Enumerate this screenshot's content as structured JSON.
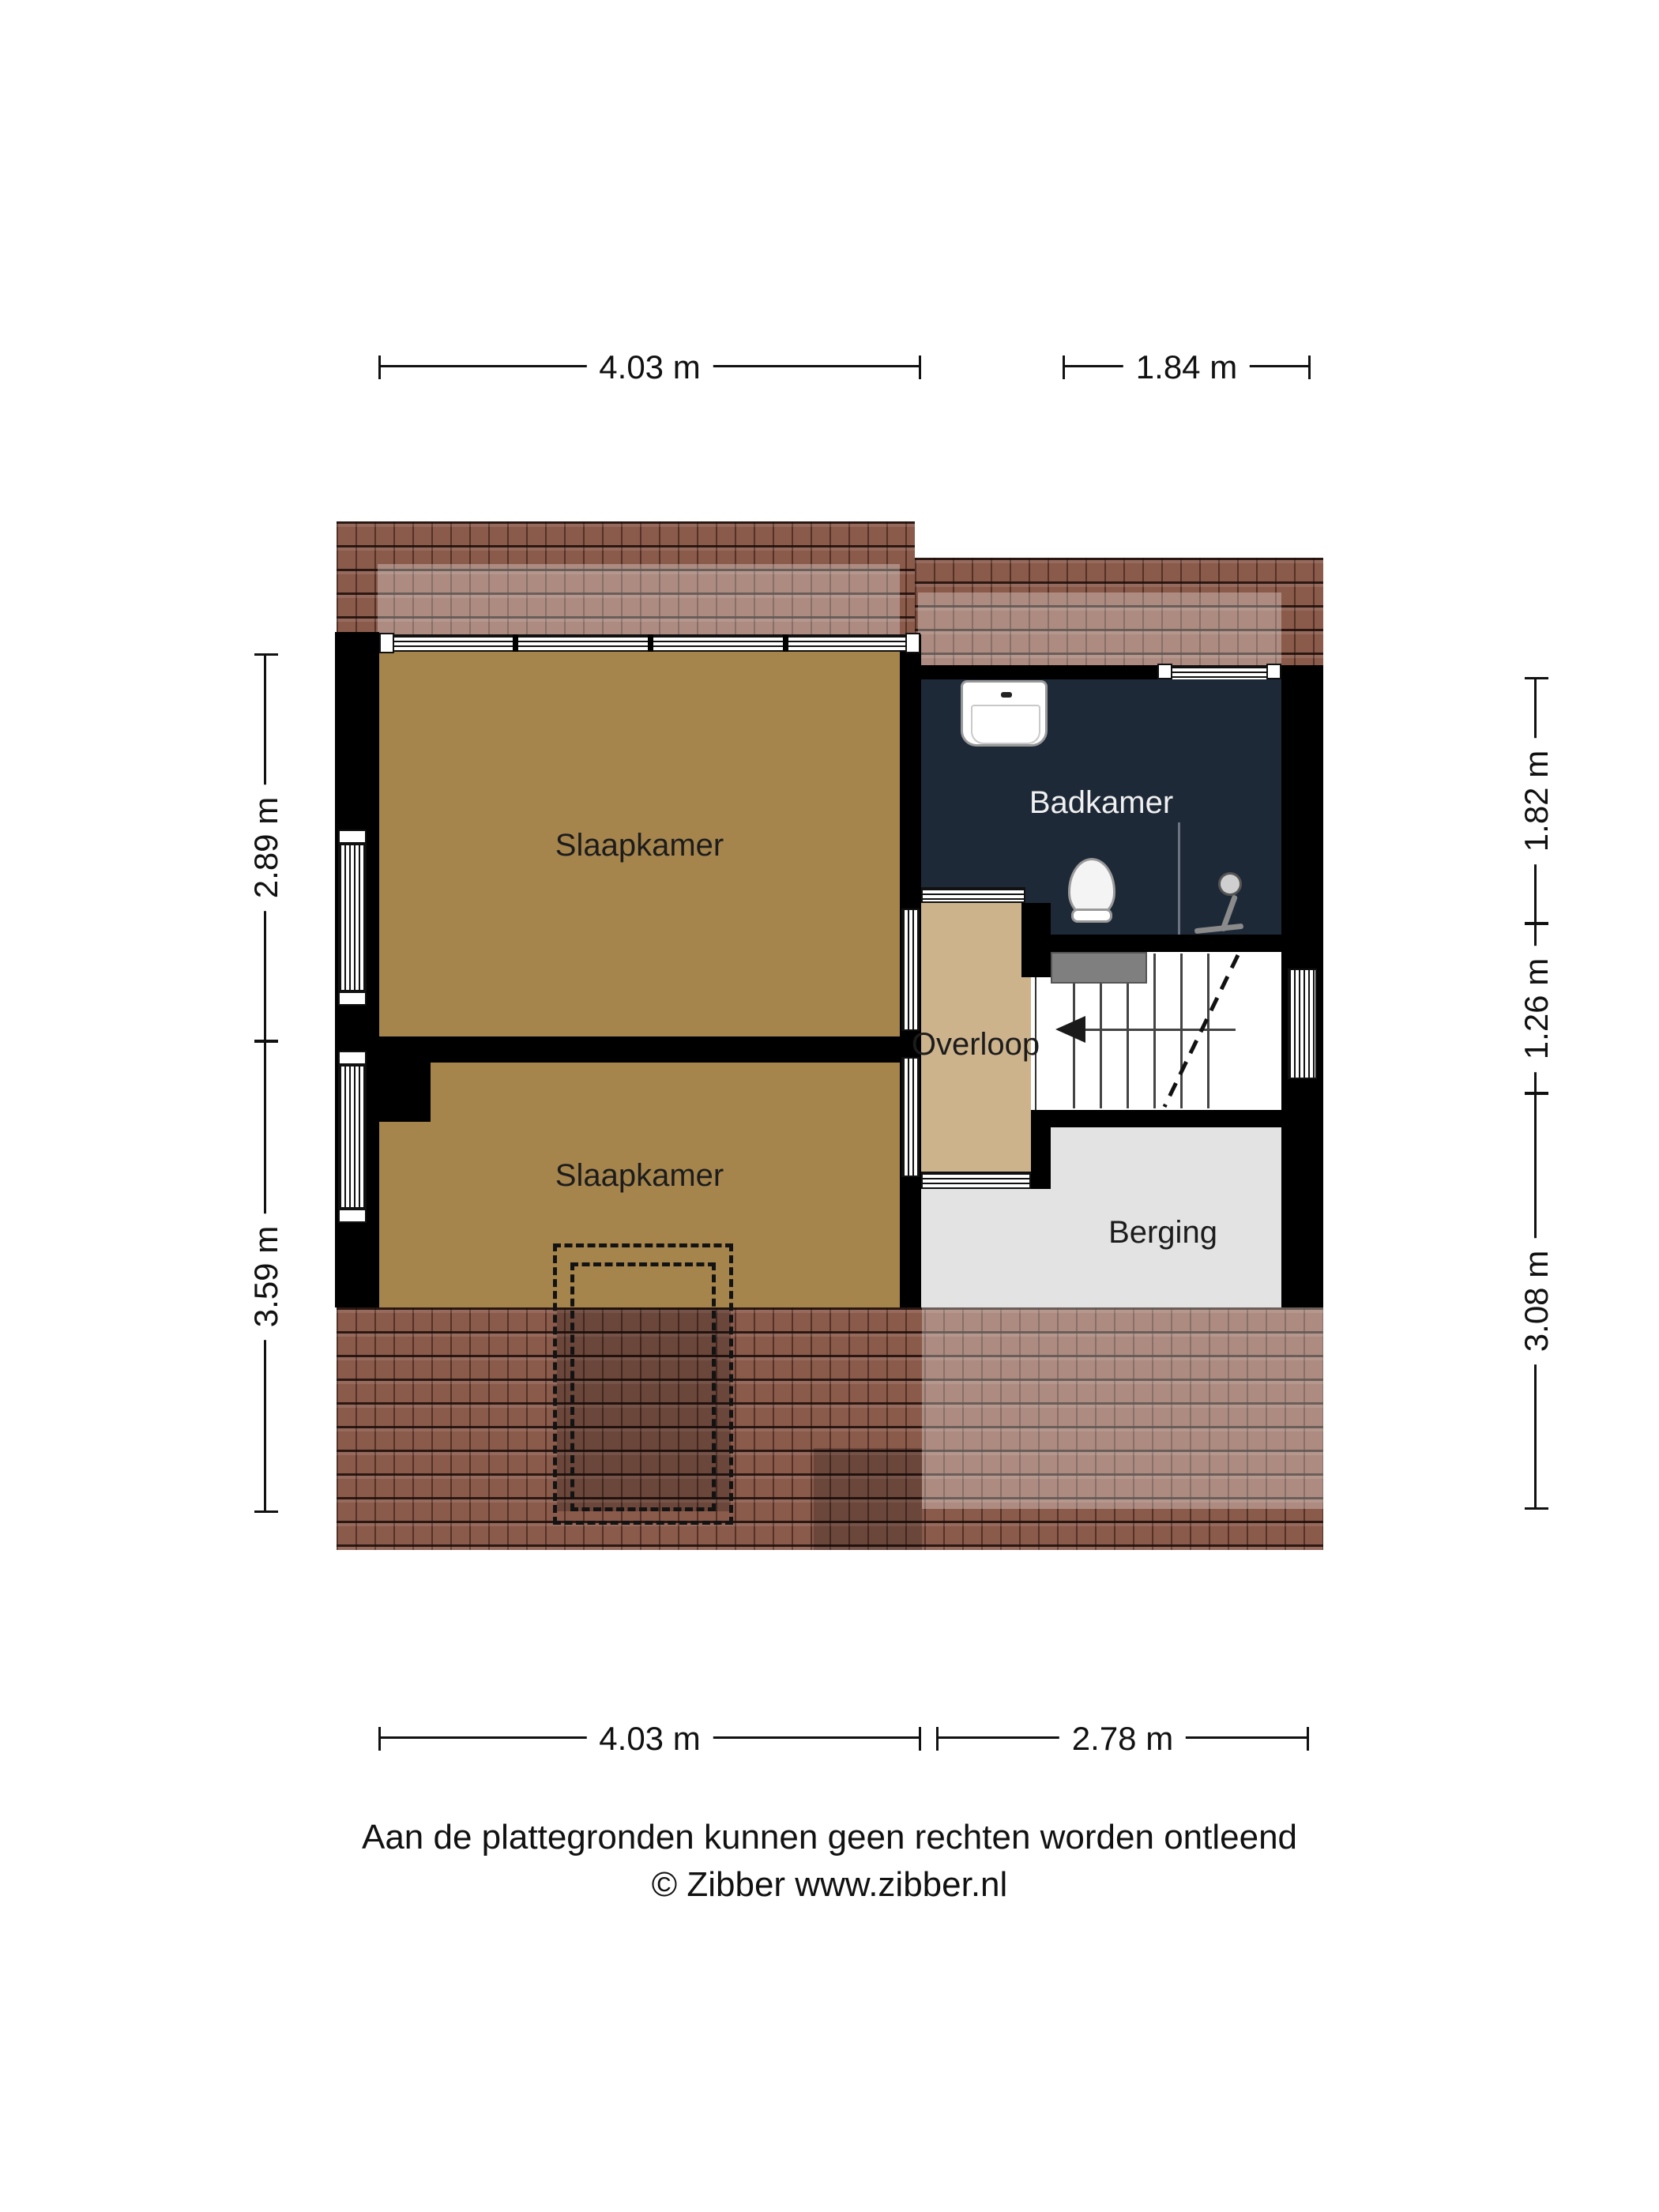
{
  "rooms": {
    "slaapkamer1": {
      "label": "Slaapkamer"
    },
    "badkamer": {
      "label": "Badkamer"
    },
    "overloop": {
      "label": "Overloop"
    },
    "slaapkamer2": {
      "label": "Slaapkamer"
    },
    "berging": {
      "label": "Berging"
    }
  },
  "dims": {
    "top_left": "4.03 m",
    "top_right": "1.84 m",
    "left_top": "2.89 m",
    "left_bottom": "3.59 m",
    "right_top": "1.82 m",
    "right_middle": "1.26 m",
    "right_bottom": "3.08 m",
    "bottom_left": "4.03 m",
    "bottom_right": "2.78 m"
  },
  "footer": {
    "line1": "Aan de plattegronden kunnen geen rechten worden ontleend",
    "line2": "© Zibber www.zibber.nl"
  },
  "fixtures": [
    "sink-icon",
    "toilet-icon",
    "shower-icon",
    "radiator",
    "stairs-up-arrow",
    "dormer-dashed-outline"
  ],
  "colors": {
    "roof": "#8a5a4b",
    "bedroom": "#a6854d",
    "landing": "#cdb38c",
    "bathroom": "#1e2938",
    "storage": "#e3e3e3",
    "radiator": "#7f7f7f",
    "wall": "#000000"
  }
}
